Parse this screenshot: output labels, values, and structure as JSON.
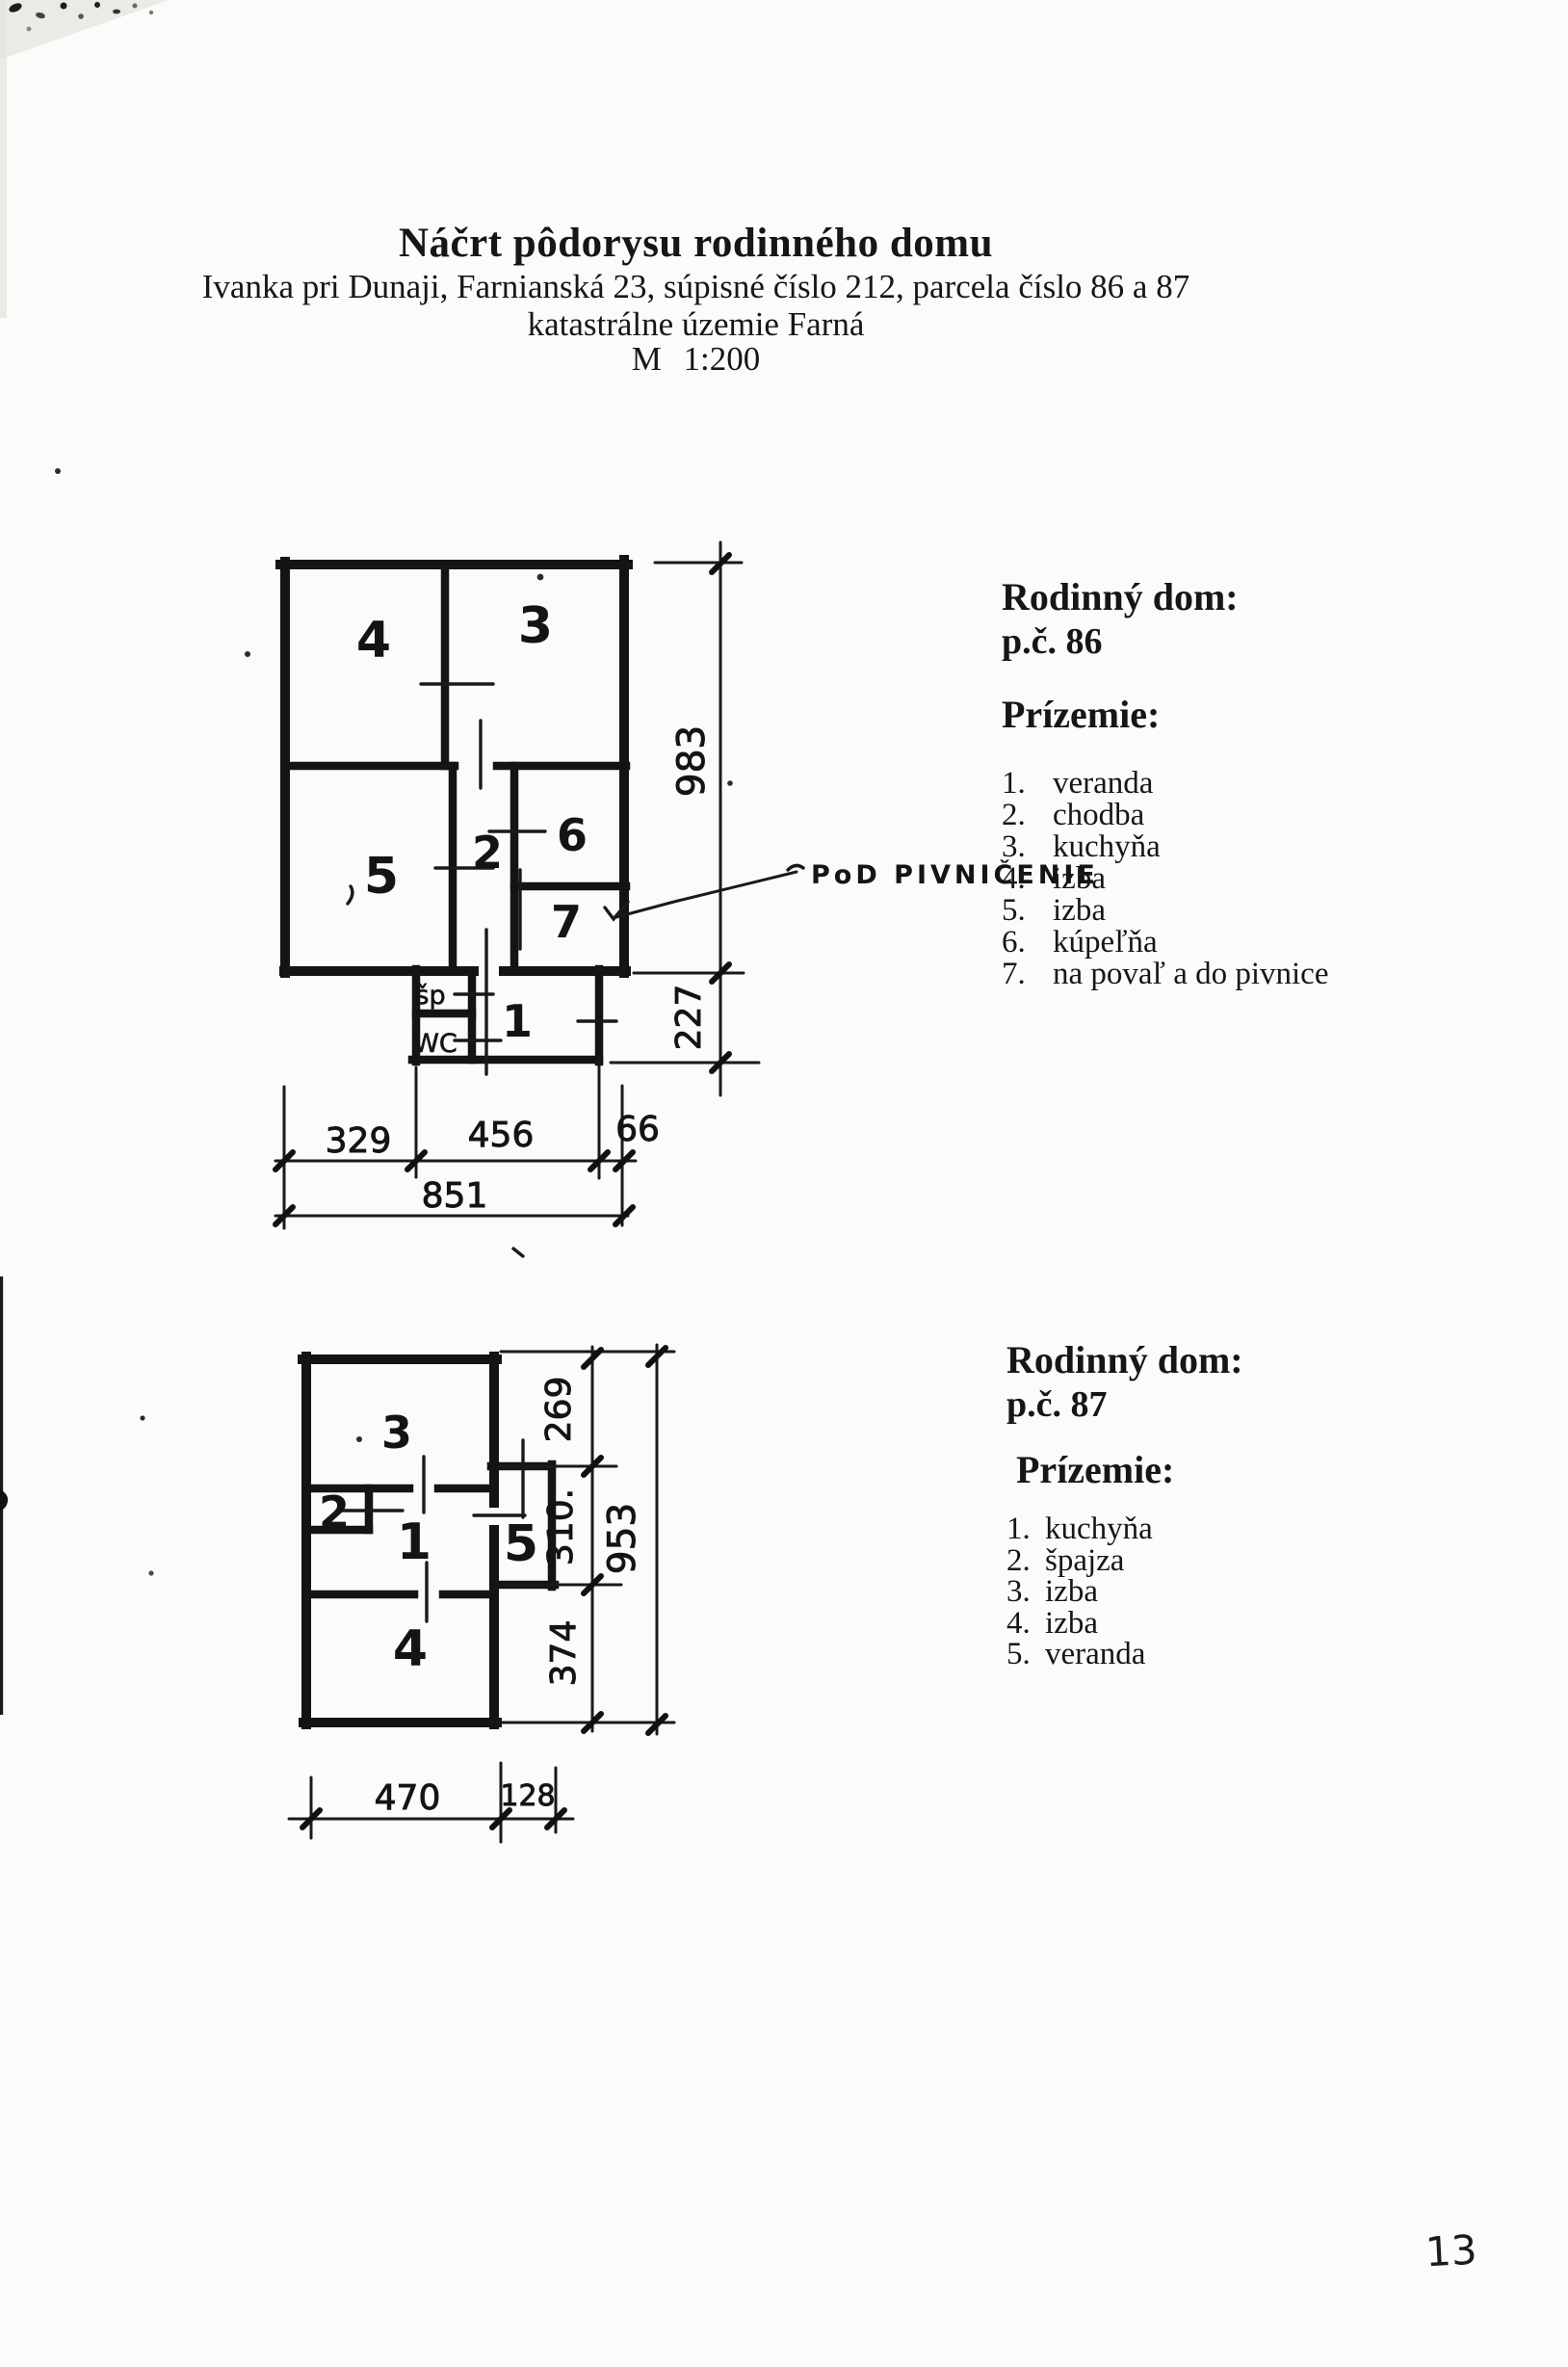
{
  "header": {
    "title": "Náčrt pôdorysu rodinného domu",
    "subtitle": "Ivanka pri Dunaji, Farnianská 23, súpisné číslo 212, parcela číslo 86 a 87",
    "subtitle2": "katastrálne územie Farná",
    "scale": "M 1:200"
  },
  "house86": {
    "heading": "Rodinný dom:",
    "parcel": "p.č. 86",
    "floor_label": "Prízemie:",
    "legend": [
      {
        "num": "1.",
        "label": "veranda"
      },
      {
        "num": "2.",
        "label": "chodba"
      },
      {
        "num": "3.",
        "label": "kuchyňa"
      },
      {
        "num": "4.",
        "label": "izba"
      },
      {
        "num": "5.",
        "label": "izba"
      },
      {
        "num": "6.",
        "label": "kúpeľňa"
      },
      {
        "num": "7.",
        "label": "na povaľ a do pivnice"
      }
    ],
    "annotation": "PoD PIVNIČENIE",
    "plan": {
      "rooms": {
        "r1": "1",
        "r2": "2",
        "r3": "3",
        "r4": "4",
        "r5": "5",
        "r6": "6",
        "r7": "7"
      },
      "labels": {
        "pantry": "šp",
        "wc": "WC"
      },
      "dims": {
        "total_height": "983",
        "annex_height": "227",
        "w1": "329",
        "w2": "456",
        "w3": "66",
        "total_width": "851"
      }
    }
  },
  "house87": {
    "heading": "Rodinný dom:",
    "parcel": "p.č. 87",
    "floor_label": "Prízemie:",
    "legend": [
      {
        "num": "1.",
        "label": "kuchyňa"
      },
      {
        "num": "2.",
        "label": "špajza"
      },
      {
        "num": "3.",
        "label": "izba"
      },
      {
        "num": "4.",
        "label": "izba"
      },
      {
        "num": "5.",
        "label": "veranda"
      }
    ],
    "plan": {
      "rooms": {
        "r1": "1",
        "r2": "2",
        "r3": "3",
        "r4": "4",
        "r5": "5"
      },
      "dims": {
        "h1": "269",
        "h2": "310.",
        "h3": "374",
        "total_height": "953",
        "w1": "470",
        "w2": "128"
      }
    }
  },
  "page": {
    "number": "13"
  }
}
